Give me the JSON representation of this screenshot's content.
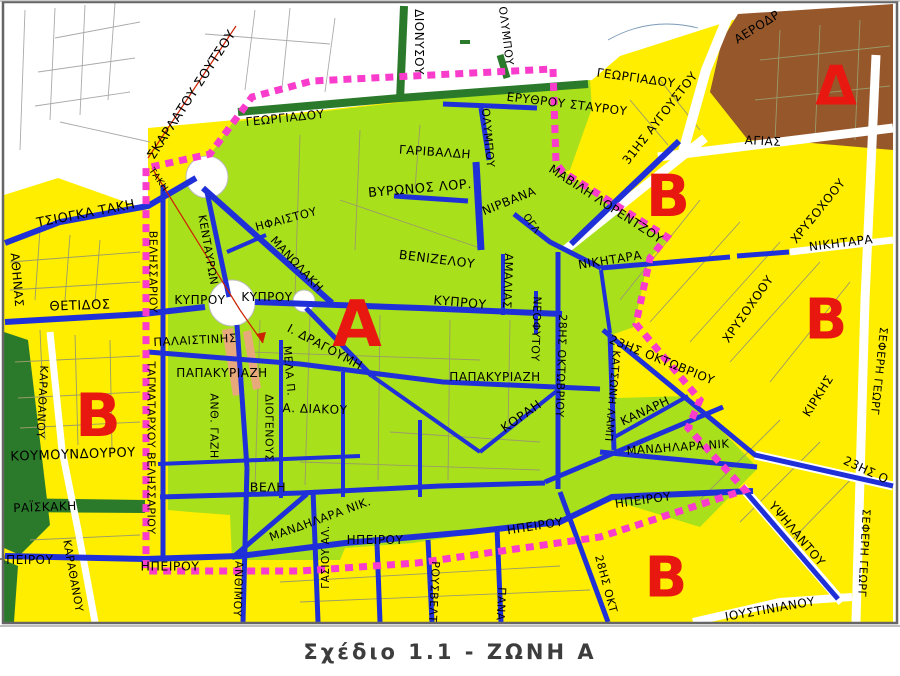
{
  "caption": {
    "text": "Σχέδιο 1.1 - ΖΩΝΗ Α"
  },
  "map": {
    "colors": {
      "zone_green": "#A8E01C",
      "zone_yellow": "#FFEE00",
      "zone_brown": "#96572B",
      "park_dark_green": "#2B7A2B",
      "street_blue": "#2030D8",
      "boundary_magenta": "#F93CCB",
      "zone_letter_red": "#E8170F",
      "route_red_line": "#CC2200",
      "label_black": "#000000"
    },
    "zone_markers": [
      {
        "text": "Α",
        "x": 357,
        "y": 325,
        "fs": 64
      },
      {
        "text": "Β",
        "x": 98,
        "y": 416,
        "fs": 60
      },
      {
        "text": "Β",
        "x": 668,
        "y": 196,
        "fs": 58
      },
      {
        "text": "Β",
        "x": 826,
        "y": 320,
        "fs": 56
      },
      {
        "text": "Β",
        "x": 666,
        "y": 578,
        "fs": 56
      },
      {
        "text": "Δ",
        "x": 836,
        "y": 86,
        "fs": 54
      }
    ],
    "street_labels": [
      {
        "text": "ΣΚΑΡΛΑΤΟΥ ΣΟΥΤΣΟΥ",
        "x": 192,
        "y": 95,
        "rot": -57,
        "fs": 13
      },
      {
        "text": "ΓΕΩΡΓΙΑΔΟΥ",
        "x": 285,
        "y": 118,
        "rot": -6,
        "fs": 12
      },
      {
        "text": "ΔΙΟΝΥΣΟΥ",
        "x": 419,
        "y": 42,
        "rot": 90,
        "fs": 12
      },
      {
        "text": "ΟΛΥΜΠΟΥ",
        "x": 506,
        "y": 36,
        "rot": 83,
        "fs": 11
      },
      {
        "text": "ΕΡΥΘΡΟΥ ΣΤΑΥΡΟΥ",
        "x": 567,
        "y": 104,
        "rot": 7,
        "fs": 12
      },
      {
        "text": "ΓΕΩΡΓΙΑΔΟΥ",
        "x": 636,
        "y": 78,
        "rot": 8,
        "fs": 12
      },
      {
        "text": "ΑΕΡΟΔΡ",
        "x": 757,
        "y": 27,
        "rot": -32,
        "fs": 12
      },
      {
        "text": "ΑΓΙΑΣ",
        "x": 763,
        "y": 141,
        "rot": 3,
        "fs": 12
      },
      {
        "text": "31ΗΣ ΑΥΓΟΥΣΤΟΥ",
        "x": 660,
        "y": 118,
        "rot": -52,
        "fs": 12
      },
      {
        "text": "ΟΛΥΜΠΟΥ",
        "x": 488,
        "y": 138,
        "rot": 85,
        "fs": 11
      },
      {
        "text": "ΓΑΡΙΒΑΛΔΗ",
        "x": 435,
        "y": 152,
        "rot": 4,
        "fs": 12
      },
      {
        "text": "ΒΥΡΩΝΟΣ ΛΟΡ.",
        "x": 420,
        "y": 189,
        "rot": -5,
        "fs": 13
      },
      {
        "text": "ΝΙΡΒΑΝΑ",
        "x": 509,
        "y": 201,
        "rot": -22,
        "fs": 12
      },
      {
        "text": "ΜΑΒΙΛΗ ΛΟΡΕΝΤΖΟΥ",
        "x": 606,
        "y": 204,
        "rot": 33,
        "fs": 12
      },
      {
        "text": "ΟΓΛ",
        "x": 531,
        "y": 224,
        "rot": 55,
        "fs": 10
      },
      {
        "text": "ΤΣΙΟΓΚΑ ΤΑΚΗ",
        "x": 86,
        "y": 214,
        "rot": -11,
        "fs": 13
      },
      {
        "text": "ΤΑΚΗ",
        "x": 158,
        "y": 180,
        "rot": 55,
        "fs": 9
      },
      {
        "text": "ΑΘΗΝΑΣ",
        "x": 17,
        "y": 280,
        "rot": 85,
        "fs": 12
      },
      {
        "text": "ΘΕΤΙΔΟΣ",
        "x": 80,
        "y": 306,
        "rot": -2,
        "fs": 13
      },
      {
        "text": "ΒΕΛΗΣΣΑΡΙΟΥ",
        "x": 153,
        "y": 272,
        "rot": 90,
        "fs": 11
      },
      {
        "text": "ΚΕΝΤΑΥΡΩΝ",
        "x": 208,
        "y": 250,
        "rot": 80,
        "fs": 11
      },
      {
        "text": "ΗΦΑΙΣΤΟΥ",
        "x": 286,
        "y": 219,
        "rot": -15,
        "fs": 11.5
      },
      {
        "text": "ΜΑΝΩΛΑΚΗ",
        "x": 297,
        "y": 264,
        "rot": 47,
        "fs": 11.5
      },
      {
        "text": "ΒΕΝΙΖΕΛΟΥ",
        "x": 437,
        "y": 259,
        "rot": 7,
        "fs": 12.5
      },
      {
        "text": "ΚΥΠΡΟΥ",
        "x": 200,
        "y": 300,
        "rot": 0,
        "fs": 12
      },
      {
        "text": "ΚΥΠΡΟΥ",
        "x": 267,
        "y": 297,
        "rot": 0,
        "fs": 12
      },
      {
        "text": "ΚΥΠΡΟΥ",
        "x": 460,
        "y": 302,
        "rot": 5,
        "fs": 12.5
      },
      {
        "text": "ΑΜΑΛΙΑΣ",
        "x": 508,
        "y": 281,
        "rot": 92,
        "fs": 11.5
      },
      {
        "text": "ΝΙΚΗΤΑΡΑ",
        "x": 610,
        "y": 260,
        "rot": -9,
        "fs": 12
      },
      {
        "text": "ΝΙΚΗΤΑΡΑ",
        "x": 841,
        "y": 243,
        "rot": -7,
        "fs": 12
      },
      {
        "text": "ΧΡΥΣΟΧΟΟΥ",
        "x": 818,
        "y": 211,
        "rot": -51,
        "fs": 12
      },
      {
        "text": "ΧΡΥΣΟΧΟΟΥ",
        "x": 748,
        "y": 309,
        "rot": -55,
        "fs": 12
      },
      {
        "text": "Ι. ΔΡΑΓΟΥΜΗ",
        "x": 325,
        "y": 347,
        "rot": 28,
        "fs": 12
      },
      {
        "text": "ΠΑΛΑΙΣΤΙΝΗΣ",
        "x": 195,
        "y": 340,
        "rot": -3,
        "fs": 11.5
      },
      {
        "text": "ΠΑΠΑΚΥΡΙΑΖΗ",
        "x": 222,
        "y": 373,
        "rot": 0,
        "fs": 12
      },
      {
        "text": "ΠΑΠΑΚΥΡΙΑΖΗ",
        "x": 495,
        "y": 377,
        "rot": 0,
        "fs": 12
      },
      {
        "text": "ΑΝΘ. ΓΑΖΗ",
        "x": 214,
        "y": 426,
        "rot": 90,
        "fs": 11
      },
      {
        "text": "ΔΙΟΓΕΝΟΥΣ",
        "x": 269,
        "y": 428,
        "rot": 90,
        "fs": 11
      },
      {
        "text": "ΜΕΛΑ Π.",
        "x": 289,
        "y": 371,
        "rot": 85,
        "fs": 11
      },
      {
        "text": "Α. ΔΙΑΚΟΥ",
        "x": 315,
        "y": 409,
        "rot": 2,
        "fs": 12
      },
      {
        "text": "ΚΟΡΑΗ",
        "x": 521,
        "y": 416,
        "rot": -35,
        "fs": 12.5
      },
      {
        "text": "ΝΕΟΦΥΤΟΥ",
        "x": 536,
        "y": 329,
        "rot": 92,
        "fs": 11
      },
      {
        "text": "28ΗΣ ΟΚΤΩΒΡΙΟΥ",
        "x": 561,
        "y": 366,
        "rot": 92,
        "fs": 11
      },
      {
        "text": "ΤΑΓΜΑΤΑΡΧΟΥ ΒΕΛΗΣΣΑΡΙΟΥ",
        "x": 151,
        "y": 448,
        "rot": 90,
        "fs": 11
      },
      {
        "text": "ΚΟΥΜΟΥΝΔΟΥΡΟΥ",
        "x": 73,
        "y": 455,
        "rot": -2,
        "fs": 13
      },
      {
        "text": "ΚΑΡΑΘΑΝΟΥ",
        "x": 42,
        "y": 402,
        "rot": 93,
        "fs": 11
      },
      {
        "text": "ΚΑΡΑΘΑΝΟΥ",
        "x": 73,
        "y": 576,
        "rot": 80,
        "fs": 11
      },
      {
        "text": "ΡΑΪΣΚΑΚΗ",
        "x": 45,
        "y": 507,
        "rot": -2,
        "fs": 12
      },
      {
        "text": "ΒΕΛΗ",
        "x": 268,
        "y": 487,
        "rot": 0,
        "fs": 12.5
      },
      {
        "text": "ΗΠΕΙΡΟΥ",
        "x": 25,
        "y": 560,
        "rot": 0,
        "fs": 12
      },
      {
        "text": "ΗΠΕΙΡΟΥ",
        "x": 170,
        "y": 566,
        "rot": 0,
        "fs": 12.5
      },
      {
        "text": "ΗΠΕΙΡΟΥ",
        "x": 375,
        "y": 540,
        "rot": 0,
        "fs": 12
      },
      {
        "text": "ΗΠΕΙΡΟΥ",
        "x": 535,
        "y": 526,
        "rot": -9,
        "fs": 12
      },
      {
        "text": "ΗΠΕΙΡΟΥ",
        "x": 643,
        "y": 500,
        "rot": -8,
        "fs": 12
      },
      {
        "text": "ΜΑΝΔΗΛΑΡΑ ΝΙΚ.",
        "x": 320,
        "y": 519,
        "rot": -20,
        "fs": 11.5
      },
      {
        "text": "ΜΑΝΔΗΛΑΡΑ ΝΙΚ",
        "x": 678,
        "y": 447,
        "rot": -4,
        "fs": 11.5
      },
      {
        "text": "ΚΑΤΣΩΝΗ ΛΑΜΠ",
        "x": 612,
        "y": 396,
        "rot": 95,
        "fs": 10.5
      },
      {
        "text": "ΚΑΝΑΡΗ",
        "x": 645,
        "y": 411,
        "rot": -25,
        "fs": 12
      },
      {
        "text": "23ΗΣ ΟΚΤΩΒΡΙΟΥ",
        "x": 662,
        "y": 360,
        "rot": 22,
        "fs": 12
      },
      {
        "text": "ΚΙΡΚΗΣ",
        "x": 818,
        "y": 396,
        "rot": -58,
        "fs": 12
      },
      {
        "text": "ΣΕΦΕΡΗ ΓΕΩΡΓ",
        "x": 879,
        "y": 371,
        "rot": 96,
        "fs": 11
      },
      {
        "text": "ΣΕΦΕΡΗ ΓΕΩΡΓ",
        "x": 864,
        "y": 553,
        "rot": 93,
        "fs": 11
      },
      {
        "text": "23ΗΣ Ο",
        "x": 866,
        "y": 470,
        "rot": 25,
        "fs": 12
      },
      {
        "text": "ΥΨΗΛΑΝΤΟΥ",
        "x": 797,
        "y": 534,
        "rot": 50,
        "fs": 12
      },
      {
        "text": "ΙΟΥΣΤΙΝΙΑΝΟΥ",
        "x": 770,
        "y": 609,
        "rot": -10,
        "fs": 12
      },
      {
        "text": "28ΗΣ ΟΚΤ",
        "x": 606,
        "y": 584,
        "rot": 75,
        "fs": 11
      },
      {
        "text": "ΓΑΣΙΟΥ ΑΛ.",
        "x": 326,
        "y": 557,
        "rot": -90,
        "fs": 10.5
      },
      {
        "text": "ΡΟΥΣΒΕΛΤ",
        "x": 434,
        "y": 592,
        "rot": 93,
        "fs": 11
      },
      {
        "text": "ΠΑΝΑ",
        "x": 501,
        "y": 604,
        "rot": 93,
        "fs": 11
      },
      {
        "text": "ΑΝΘΙΜΟΥ",
        "x": 238,
        "y": 589,
        "rot": 92,
        "fs": 11
      }
    ]
  }
}
